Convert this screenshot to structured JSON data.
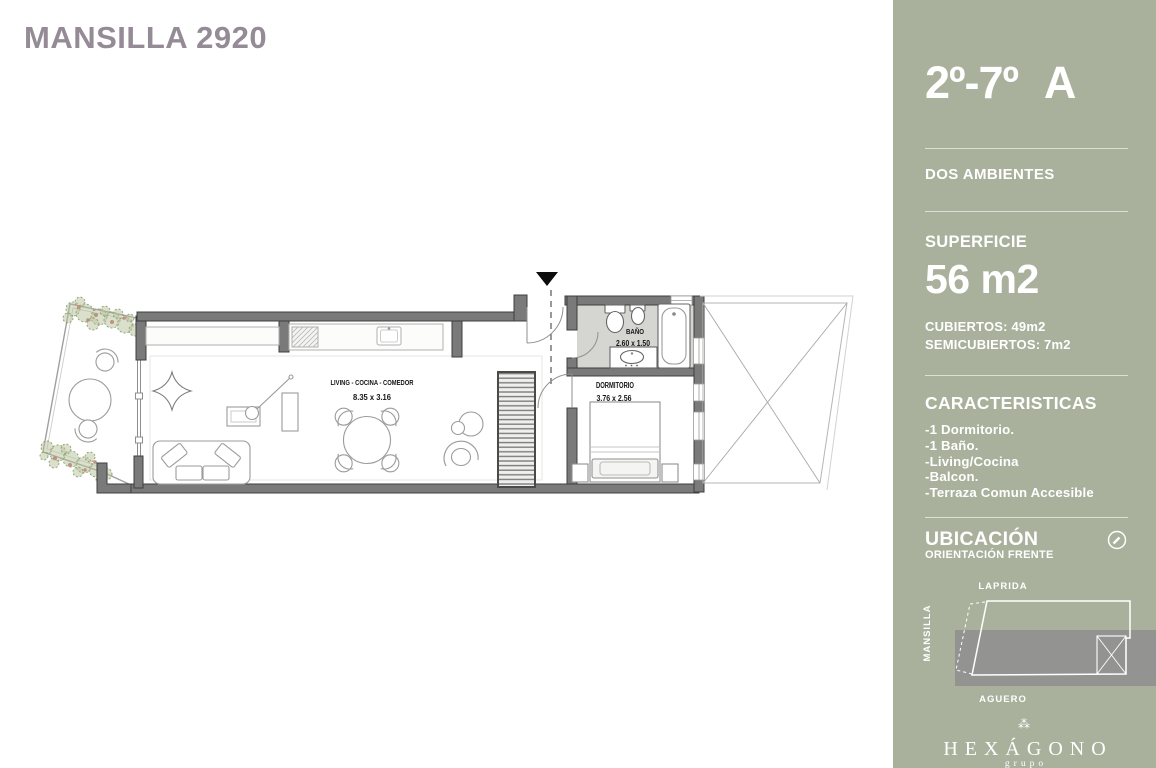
{
  "window": {
    "title": "MANSILLA 2920"
  },
  "sidebar": {
    "unit": "2º-7º",
    "unit_letter": "A",
    "dwelling_type": "DOS AMBIENTES",
    "superficie": {
      "label": "SUPERFICIE",
      "value": "56 m2",
      "cubiertos": "CUBIERTOS: 49m2",
      "semicubiertos": "SEMICUBIERTOS: 7m2"
    },
    "caracteristicas": {
      "label": "CARACTERISTICAS",
      "items": [
        "-1 Dormitorio.",
        "-1 Baño.",
        "-Living/Cocina",
        "-Balcon.",
        "-Terraza Comun Accesible"
      ]
    },
    "ubicacion": {
      "label": "UBICACIÓN",
      "orientacion": "ORIENTACIÓN FRENTE"
    },
    "map": {
      "street_top": "LAPRIDA",
      "street_left": "MANSILLA",
      "street_bottom": "AGUERO"
    },
    "brand": {
      "glyph": "⁂",
      "name": "HEXÁGONO",
      "subtitle": "grupo"
    }
  },
  "plan": {
    "rooms": [
      {
        "name": "LIVING - COCINA - COMEDOR",
        "dims": "8.35 x 3.16"
      },
      {
        "name": "BAÑO",
        "dims": "2.60 x 1.50"
      },
      {
        "name": "DORMITORIO",
        "dims": "3.76 x 2.56"
      }
    ]
  },
  "colors": {
    "sidebar_green": "#a9b19c",
    "title_mauve": "#948b96",
    "wall_gray": "#6f6f6f"
  }
}
